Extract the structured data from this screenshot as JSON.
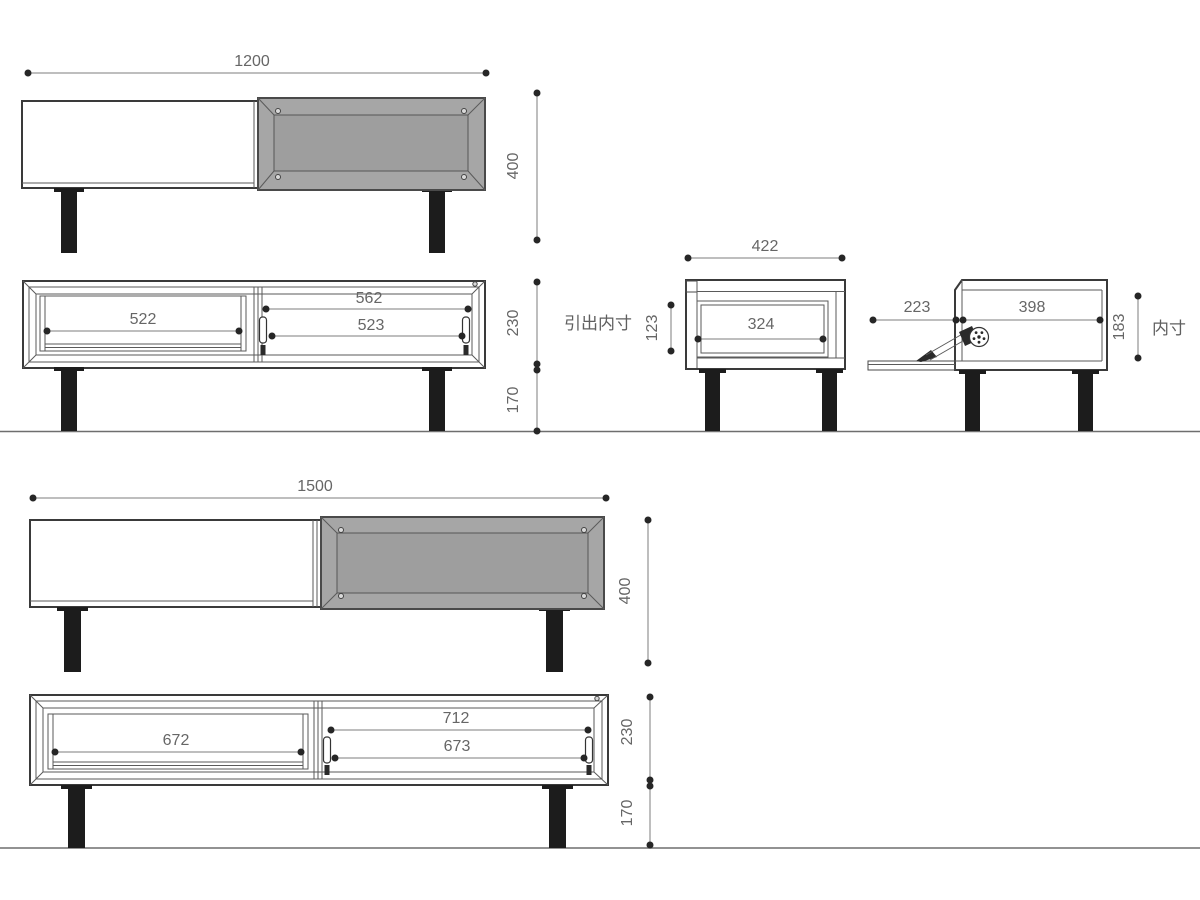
{
  "views": {
    "front_small": {
      "width": "1200",
      "height": "400"
    },
    "front_small_open": {
      "drawer_width": "522",
      "opening_width": "562",
      "flap_width": "523",
      "body_height": "230",
      "leg_height": "170"
    },
    "side_drawer": {
      "total_depth": "422",
      "inner_height": "123",
      "inner_depth": "324",
      "caption": "引出内寸"
    },
    "side_flap": {
      "door_reach": "223",
      "inner_depth": "398",
      "inner_height": "183",
      "caption": "内寸"
    },
    "front_large": {
      "width": "1500",
      "height": "400"
    },
    "front_large_open": {
      "drawer_width": "672",
      "opening_width": "712",
      "flap_width": "673",
      "body_height": "230",
      "leg_height": "170"
    }
  },
  "colors": {
    "background": "#ffffff",
    "body_line": "#3a3a3a",
    "dimension_line": "#7d7d7d",
    "dimension_text": "#666666",
    "door_fill": "#a6a6a6",
    "door_panel_fill": "#9e9e9e",
    "leg_fill": "#1c1c1c"
  }
}
